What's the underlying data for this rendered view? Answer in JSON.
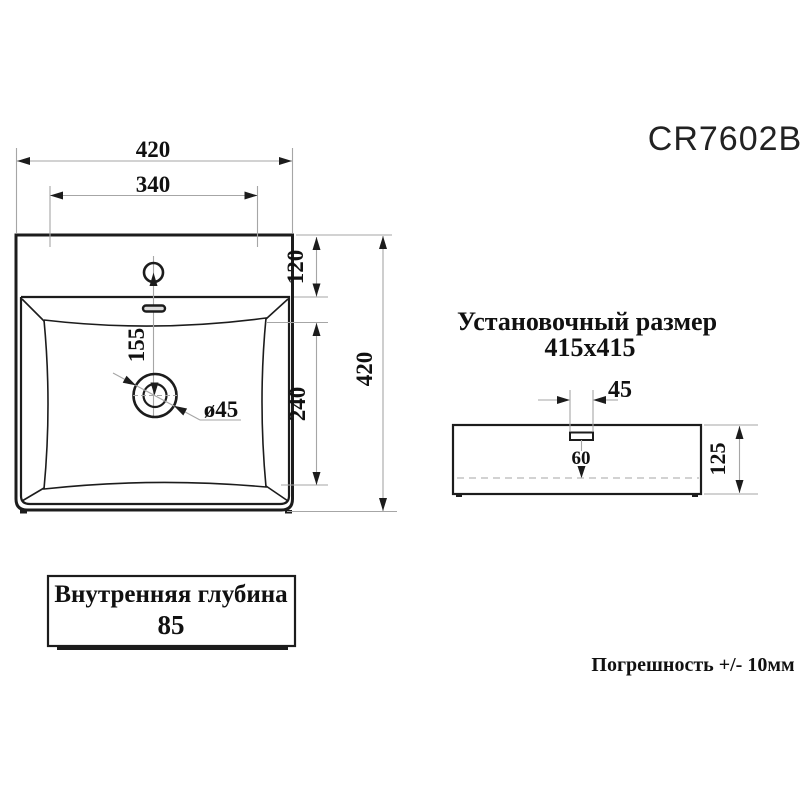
{
  "title": "CR7602B",
  "top_view": {
    "dim_overall_width": "420",
    "dim_inner_width": "340",
    "dim_rim_depth": "120",
    "dim_basin_length": "240",
    "dim_overall_height": "420",
    "dim_faucet_to_drain": "155",
    "dim_drain_diameter": "ø45"
  },
  "install_note": {
    "line1": "Установочный размер",
    "line2": "415x415"
  },
  "side_view": {
    "dim_hole_width": "45",
    "dim_hole_depth": "60",
    "dim_height": "125"
  },
  "depth_box": {
    "label": "Внутренняя глубина",
    "value": "85"
  },
  "tolerance_note": "Погрешность +/- 10мм",
  "colors": {
    "drawing_line": "#1c1c1c",
    "dimension_line": "#a6a6a6",
    "text": "#111111",
    "background": "#ffffff"
  }
}
